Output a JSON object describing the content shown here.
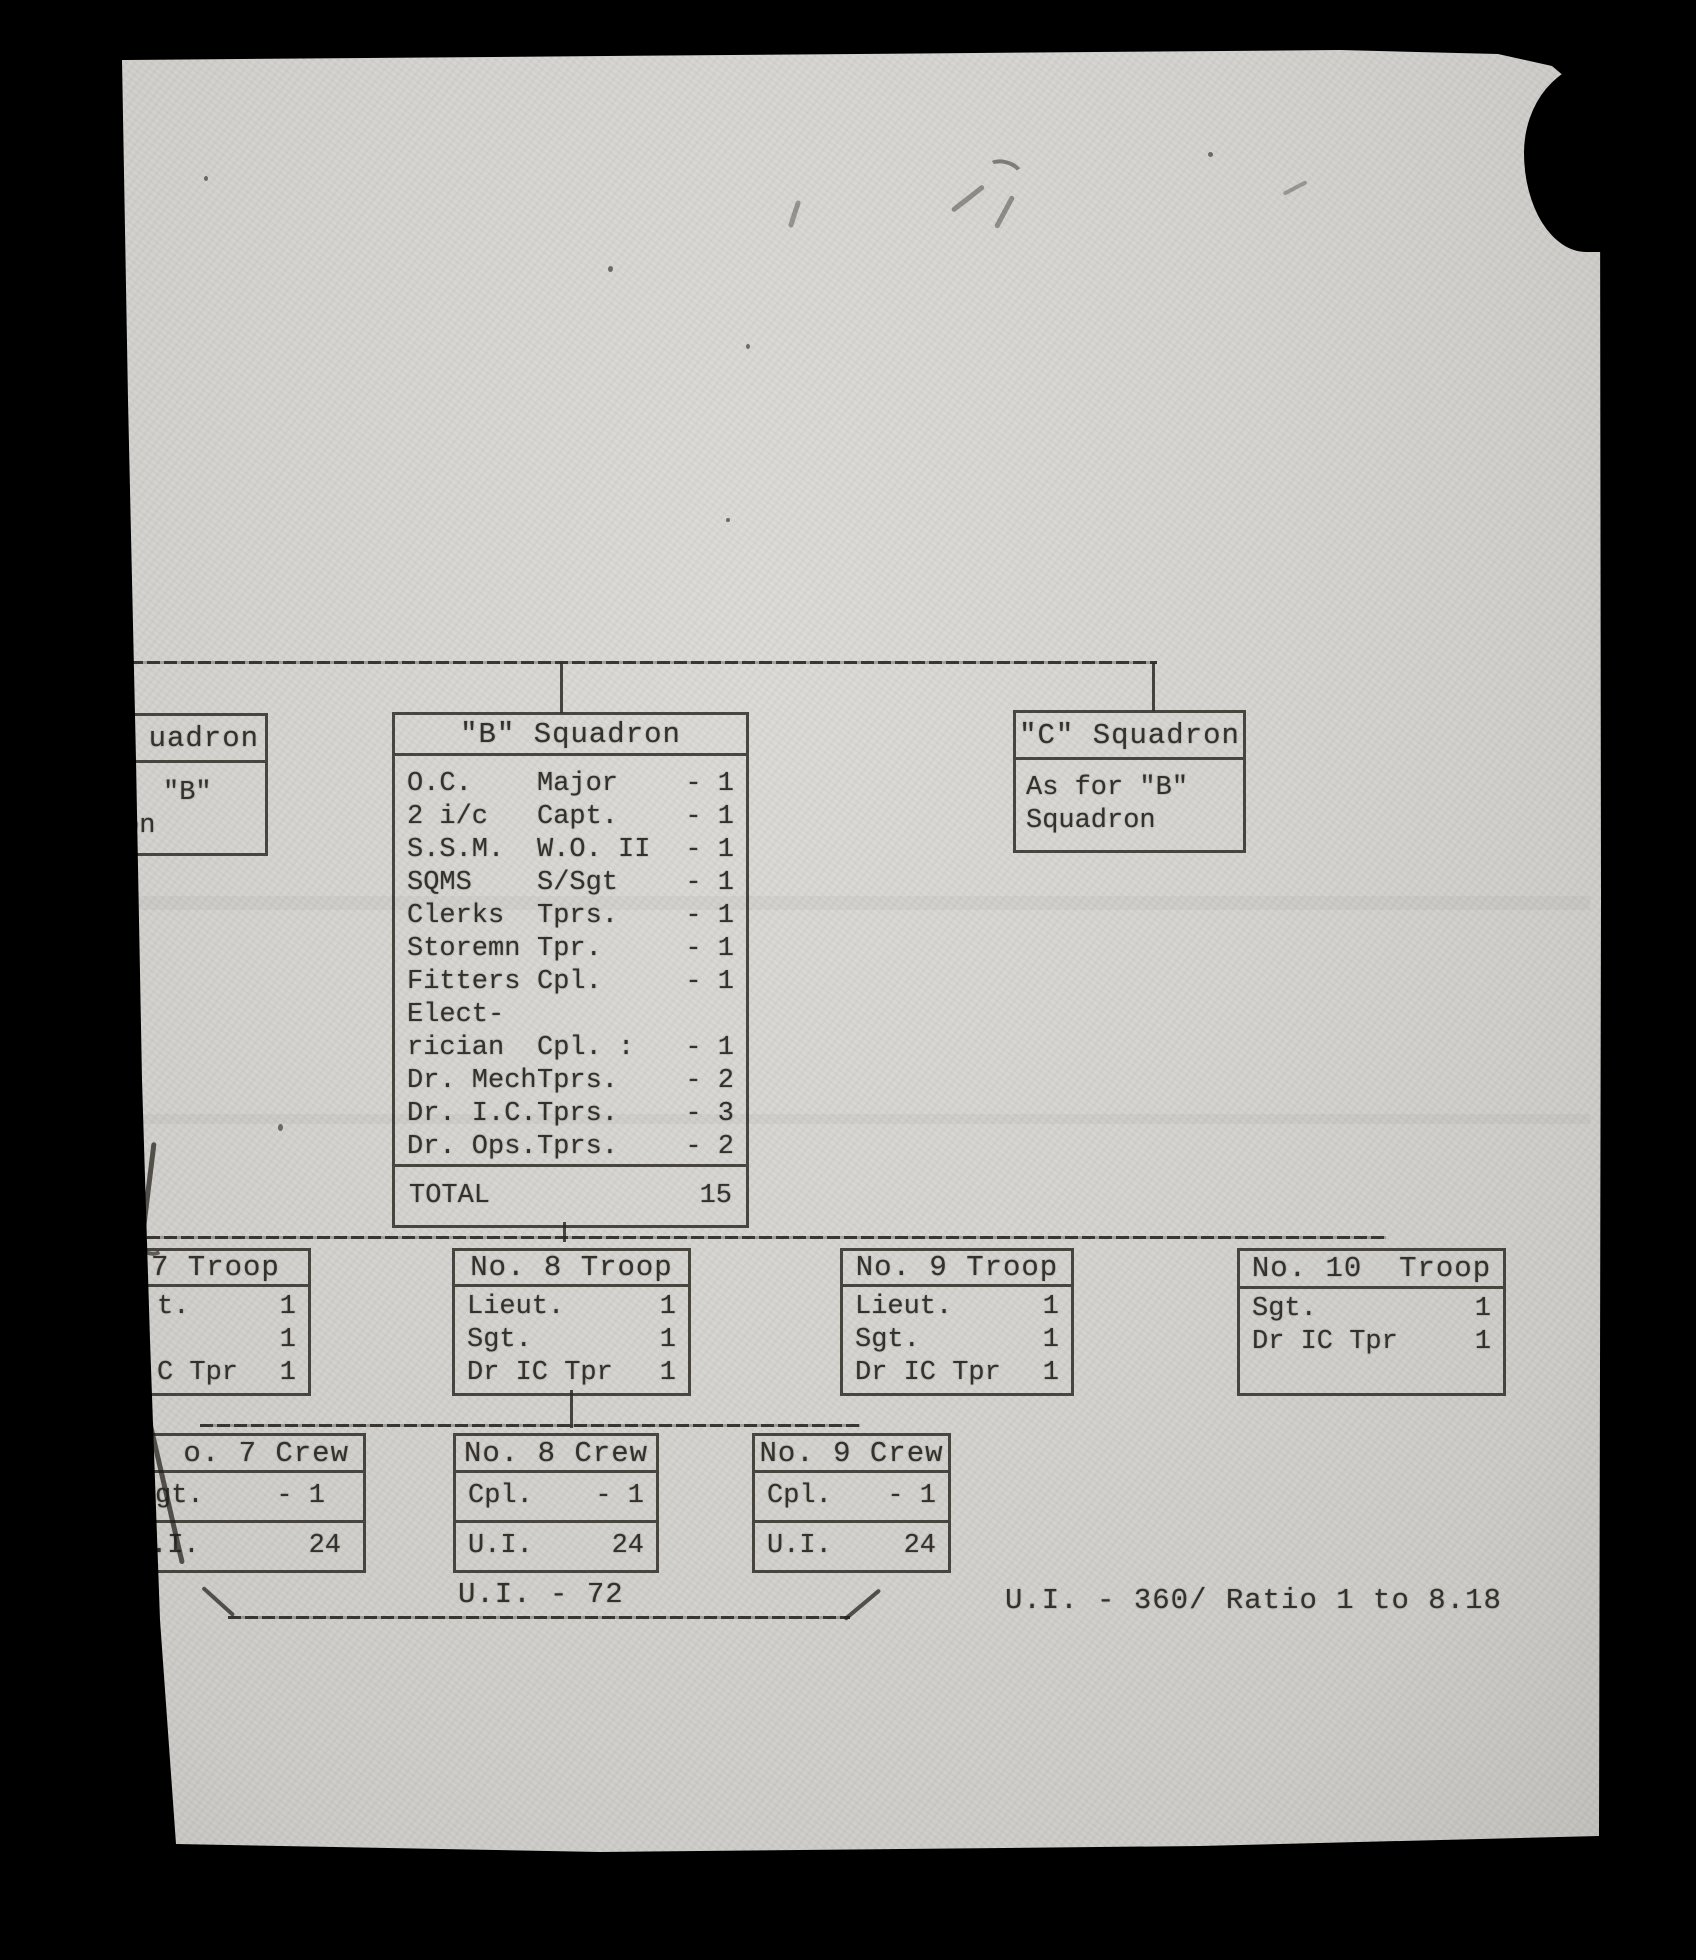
{
  "colors": {
    "background": "#000000",
    "paper": "#d6d5d1",
    "ink": "#35322c"
  },
  "diagram": {
    "squadron_a": {
      "title": "uadron",
      "line1": "\"B\"",
      "line2": "on"
    },
    "squadron_b": {
      "title": "\"B\" Squadron",
      "personnel": [
        {
          "role": "O.C.",
          "rank": "Major",
          "count": "- 1"
        },
        {
          "role": "2 i/c",
          "rank": "Capt.",
          "count": "- 1"
        },
        {
          "role": "S.S.M.",
          "rank": "W.O. II",
          "count": "- 1"
        },
        {
          "role": "SQMS",
          "rank": "S/Sgt",
          "count": "- 1"
        },
        {
          "role": "Clerks",
          "rank": "Tprs.",
          "count": "- 1"
        },
        {
          "role": "Storemn",
          "rank": "Tpr.",
          "count": "- 1"
        },
        {
          "role": "Fitters",
          "rank": "Cpl.",
          "count": "- 1"
        },
        {
          "role": "Elect-",
          "rank": "",
          "count": ""
        },
        {
          "role": "rician",
          "rank": "Cpl. :",
          "count": "- 1"
        },
        {
          "role": "Dr. Mech",
          "rank": "Tprs.",
          "count": "- 2"
        },
        {
          "role": "Dr. I.C.",
          "rank": "Tprs.",
          "count": "- 3"
        },
        {
          "role": "Dr. Ops.",
          "rank": "Tprs.",
          "count": "- 2"
        }
      ],
      "total_label": "TOTAL",
      "total_value": "15"
    },
    "squadron_c": {
      "title": "\"C\" Squadron",
      "line1": "As for \"B\"",
      "line2": "Squadron"
    },
    "troops": [
      {
        "title": "7 Troop",
        "rows": [
          {
            "label": "t.",
            "count": "1"
          },
          {
            "label": "",
            "count": "1"
          },
          {
            "label": "C Tpr",
            "count": "1"
          }
        ]
      },
      {
        "title": "No. 8 Troop",
        "rows": [
          {
            "label": "Lieut.",
            "count": "1"
          },
          {
            "label": "Sgt.",
            "count": "1"
          },
          {
            "label": "Dr IC Tpr",
            "count": "1"
          }
        ]
      },
      {
        "title": "No. 9 Troop",
        "rows": [
          {
            "label": "Lieut.",
            "count": "1"
          },
          {
            "label": "Sgt.",
            "count": "1"
          },
          {
            "label": "Dr IC Tpr",
            "count": "1"
          }
        ]
      },
      {
        "title": "No. 10  Troop",
        "rows": [
          {
            "label": "",
            "count": ""
          },
          {
            "label": "Sgt.",
            "count": "1"
          },
          {
            "label": "Dr IC Tpr",
            "count": "1"
          }
        ]
      }
    ],
    "crews": [
      {
        "title": "o. 7 Crew",
        "person_label": "gt.",
        "person_count": "- 1",
        "ui_label": ".I.",
        "ui_count": "24"
      },
      {
        "title": "No. 8 Crew",
        "person_label": "Cpl.",
        "person_count": "- 1",
        "ui_label": "U.I.",
        "ui_count": "24"
      },
      {
        "title": "No. 9 Crew",
        "person_label": "Cpl.",
        "person_count": "- 1",
        "ui_label": "U.I.",
        "ui_count": "24"
      }
    ],
    "crew_total": "U.I. - 72",
    "footnote": "U.I. - 360/ Ratio 1 to 8.18"
  }
}
